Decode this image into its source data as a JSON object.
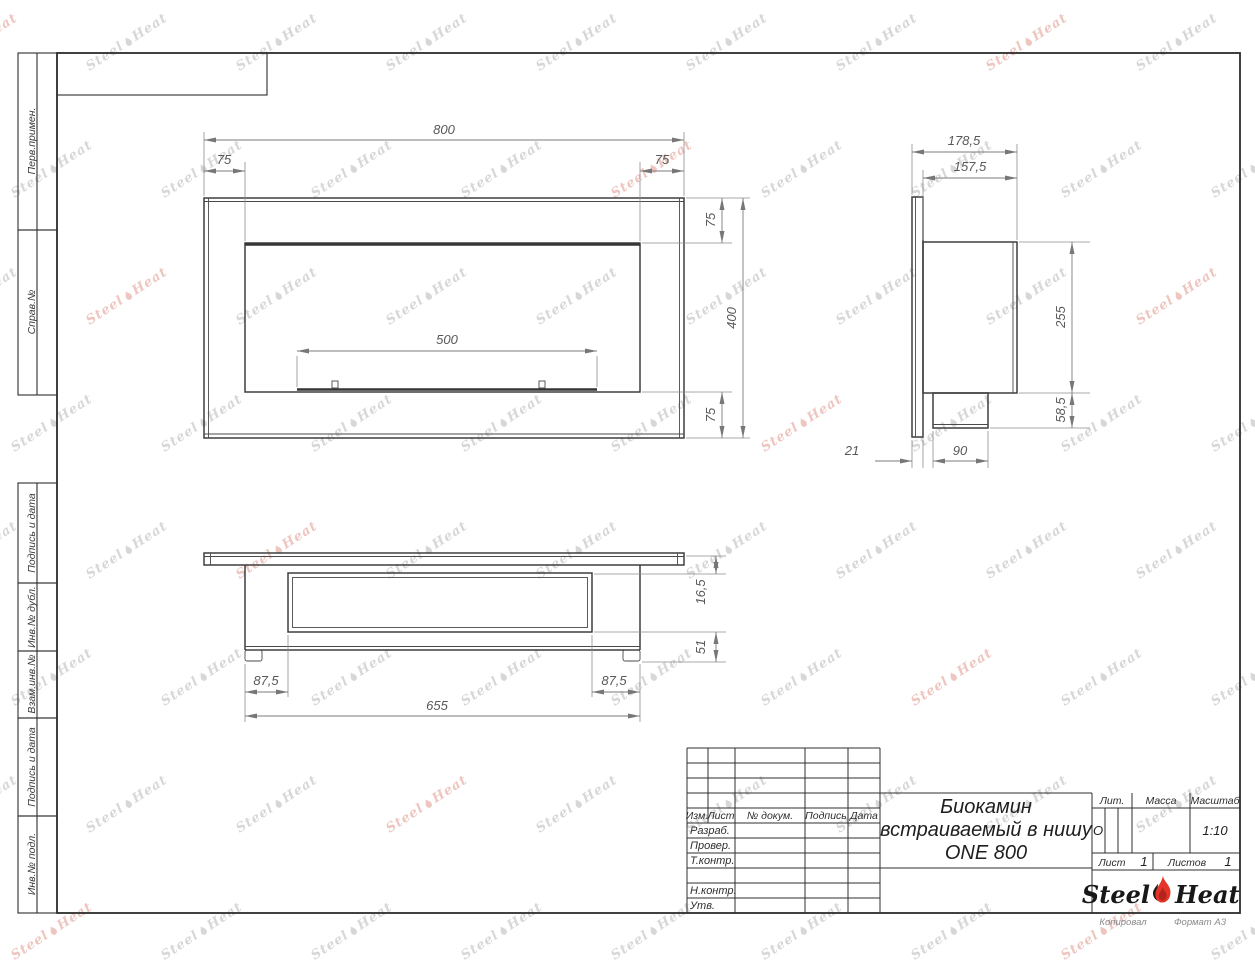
{
  "sheet": {
    "side_labels": [
      "Перв.примен.",
      "Справ.№",
      "Подпись и дата",
      "Инв.№ дубл.",
      "Взам.инв.№",
      "Подпись и дата",
      "Инв.№ подл."
    ],
    "footer": {
      "copied": "Копировал",
      "format": "Формат А3"
    }
  },
  "title_block": {
    "header_cols": [
      "Изм.",
      "Лист",
      "№ докум.",
      "Подпись",
      "Дата"
    ],
    "role_rows": [
      "Разраб.",
      "Провер.",
      "Т.контр.",
      "Н.контр.",
      "Утв."
    ],
    "title_lines": [
      "Биокамин",
      "встраиваемый в нишу",
      "ONE 800"
    ],
    "lit": {
      "label": "Лит.",
      "value": "О"
    },
    "mass": {
      "label": "Масса",
      "value": ""
    },
    "scale": {
      "label": "Масштаб",
      "value": "1:10"
    },
    "sheet_no": {
      "label": "Лист",
      "value": "1"
    },
    "sheets_total": {
      "label": "Листов",
      "value": "1"
    },
    "logo": {
      "first": "Steel",
      "second": "Heat"
    }
  },
  "dimensions": {
    "front": {
      "total_width": "800",
      "left_margin": "75",
      "right_margin": "75",
      "top_margin": "75",
      "height": "400",
      "bottom_margin": "75",
      "burner_width": "500"
    },
    "side": {
      "total_depth": "178,5",
      "body_depth": "157,5",
      "body_height": "255",
      "burner_height": "58,5",
      "flange_thickness": "21",
      "burner_depth": "90"
    },
    "bottom": {
      "flange_offset": "16,5",
      "lower_height": "51",
      "left_inset": "87,5",
      "right_inset": "87,5",
      "body_width": "655"
    }
  },
  "watermark": {
    "first": "Steel",
    "second": "Heat"
  },
  "colors": {
    "line": "#3e3e3e",
    "dim": "#7b7b7b",
    "accent_red": "#e63327"
  }
}
